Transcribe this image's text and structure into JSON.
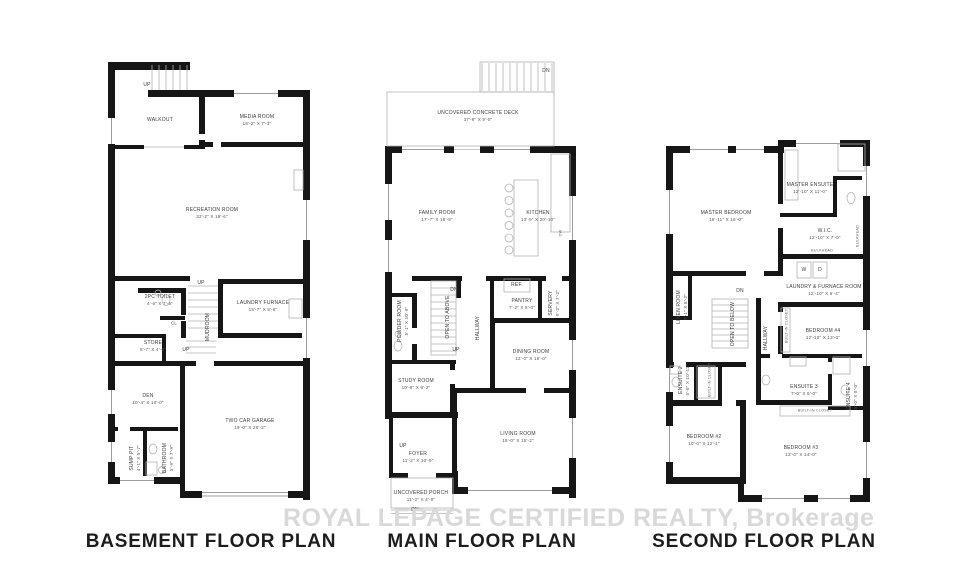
{
  "watermark": "ROYAL LEPAGE CERTIFIED REALTY, Brokerage",
  "basement": {
    "title": "BASEMENT FLOOR PLAN",
    "labels": {
      "up_top": "UP",
      "walkout": {
        "name": "WALKOUT",
        "dims": ""
      },
      "media": {
        "name": "MEDIA ROOM",
        "dims": "16'-2\" X 7'-3\""
      },
      "recreation": {
        "name": "RECREATION ROOM",
        "dims": "32'-2\" X 19'-6\""
      },
      "toilet": {
        "name": "2PC TOILET",
        "dims": "4'-6\" X 7'-6\""
      },
      "up_mid": "UP",
      "laundry_furnace": {
        "name": "LAUNDRY FURNACE",
        "dims": "15'-7\" X 8'-6\""
      },
      "mudroom": "MUDROOM",
      "cl": "CL",
      "store": {
        "name": "STORE",
        "dims": "5'-7\" X 4'-0\""
      },
      "up_store": "UP",
      "den": {
        "name": "DEN",
        "dims": "10'-4\" X 10'-0\""
      },
      "garage": {
        "name": "TWO CAR GARAGE",
        "dims": "19'-0\" X 20'-2\""
      },
      "sump_pit": {
        "name": "SUMP PIT",
        "dims": "4'-1\" X 5'-7\""
      },
      "bathroom": {
        "name": "BATHROOM",
        "dims": "5'-9\" X 7'-9\""
      }
    }
  },
  "main": {
    "title": "MAIN FLOOR PLAN",
    "labels": {
      "dn_deck": "DN",
      "deck": {
        "name": "UNCOVERED CONCRETE DECK",
        "dims": "37'-9\" X 9'-0\""
      },
      "family": {
        "name": "FAMILY ROOM",
        "dims": "17'-7\" X 16'-9\""
      },
      "kitchen": {
        "name": "KITCHEN",
        "dims": "13'-9\" X 20'-10\""
      },
      "ref": "REF.",
      "dw": "DW",
      "powder": {
        "name": "POWDER ROOM",
        "dims": "5'-1\" X 10'-9\""
      },
      "open_above": "OPEN TO ABOVE",
      "dn_stairs": "DN",
      "up_stairs": "UP",
      "hallway": "HALLWAY",
      "pantry": {
        "name": "PANTRY",
        "dims": "7'-2\" X 8'-0\""
      },
      "servery": {
        "name": "SERVERY",
        "dims": "5'-2\" X 7'-2\""
      },
      "dining": {
        "name": "DINING ROOM",
        "dims": "12'-0\" X 16'-0\""
      },
      "study": {
        "name": "STUDY ROOM",
        "dims": "10'-9\" X 9'-2\""
      },
      "living": {
        "name": "LIVING ROOM",
        "dims": "16'-0\" X 15'-2\""
      },
      "up_foyer": "UP",
      "foyer": {
        "name": "FOYER",
        "dims": "11'-2\" X 10'-9\""
      },
      "porch": {
        "name": "UNCOVERED PORCH",
        "dims": "11'-2\" X 4'-0\""
      },
      "dn_porch": "DN"
    }
  },
  "second": {
    "title": "SECOND FLOOR PLAN",
    "labels": {
      "master": {
        "name": "MASTER BEDROOM",
        "dims": "16'-11\" X 16'-0\""
      },
      "master_ensuite": {
        "name": "MASTER ENSUITE",
        "dims": "12'-10\" X 11'-0\""
      },
      "wic": {
        "name": "W.I.C.",
        "dims": "12'-10\" X 7'-0\""
      },
      "washer": "W",
      "dryer": "D",
      "laundry_room": {
        "name": "LAUNDRY & FURNACE ROOM",
        "dims": "12'-10\" X 6'-4\""
      },
      "bulkhead_a": "BULKHEAD",
      "bulkhead_b": "BULKHEAD",
      "linen": {
        "name": "LINEN ROOM",
        "dims": "2'-1\" X 8'-2\""
      },
      "dn_stairs": "DN",
      "open_below": "OPEN TO BELOW",
      "hallway": "HALLWAY",
      "closet_b4": "BUILT-IN CLOSET",
      "bedroom4": {
        "name": "BEDROOM #4",
        "dims": "12'-10\" X 13'-0\""
      },
      "ensuite2": {
        "name": "ENSUITE 2",
        "dims": "5'-0\" X 10'-11\""
      },
      "closet_b2": "BUILT-IN CLOSET",
      "bedroom2": {
        "name": "BEDROOM #2",
        "dims": "10'-0\" X 12'-1\""
      },
      "ensuite3": {
        "name": "ENSUITE 3",
        "dims": "7'-0\" X 5'-0\""
      },
      "ensuite4": {
        "name": "ENSUITE 4",
        "dims": "5'-0\" X 8'-0\""
      },
      "closet_b3": "BUILT-IN CLOSET",
      "bedroom3": {
        "name": "BEDROOM #3",
        "dims": "13'-0\" X 14'-0\""
      }
    }
  }
}
